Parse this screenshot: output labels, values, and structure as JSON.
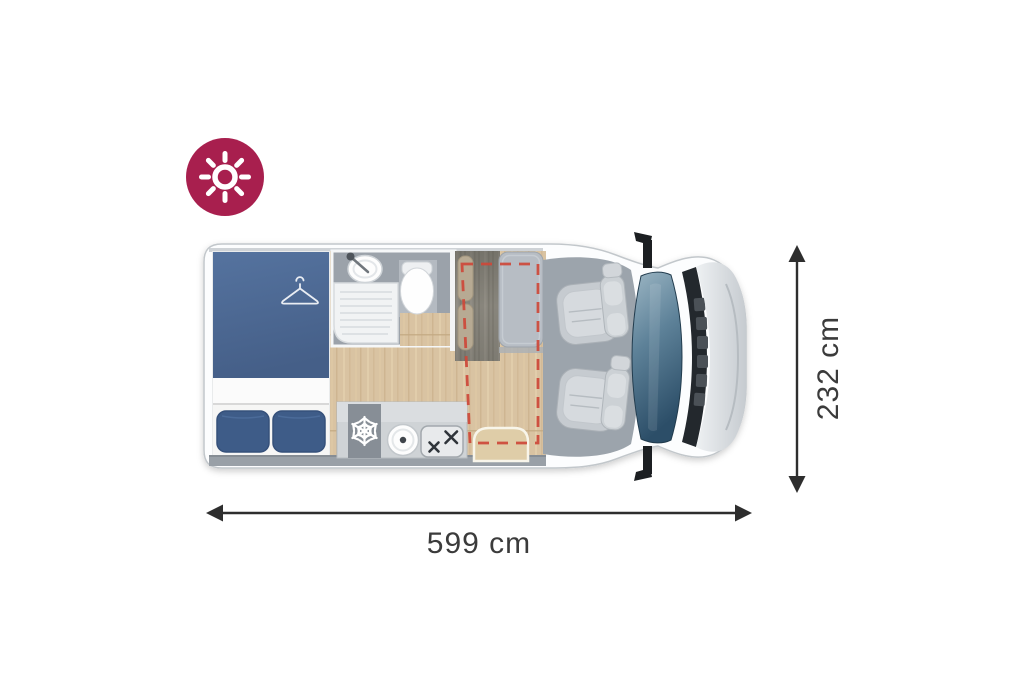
{
  "badge": {
    "icon": "sun-icon",
    "background_color": "#A81F4E",
    "icon_color": "#FFFFFF"
  },
  "dimensions": {
    "length": {
      "label": "599 cm"
    },
    "height": {
      "label": "232 cm"
    },
    "arrow_color": "#2E2E2E",
    "label_color": "#3B3B3B"
  },
  "floorplan": {
    "highlight_dash_color": "#CD4838",
    "colors": {
      "van_body": "#FCFDFE",
      "bed_blue": "#4C6993",
      "pillow_blue": "#3E5C88",
      "wood_floor": "#D9C3A2",
      "bathroom_floor": "#9BA2AA",
      "bench_upholstery": "#8E8B82",
      "cabinet_gray": "#B7BDC4",
      "cab_floor": "#9CA4AC",
      "seat_gray": "#C6CBD0",
      "windshield_blue": "#47708C"
    },
    "features": [
      {
        "name": "double-bed"
      },
      {
        "name": "hanger-icon"
      },
      {
        "name": "washroom-sink"
      },
      {
        "name": "shower-tray"
      },
      {
        "name": "toilet"
      },
      {
        "name": "snowflake-fridge-icon"
      },
      {
        "name": "kitchen-sink"
      },
      {
        "name": "two-burner-stove"
      },
      {
        "name": "travel-bench"
      },
      {
        "name": "wardrobe-cabinet"
      },
      {
        "name": "removable-table"
      },
      {
        "name": "driver-seat"
      },
      {
        "name": "passenger-seat"
      },
      {
        "name": "drop-down-bed-zone"
      },
      {
        "name": "windshield"
      },
      {
        "name": "side-mirrors"
      }
    ]
  }
}
